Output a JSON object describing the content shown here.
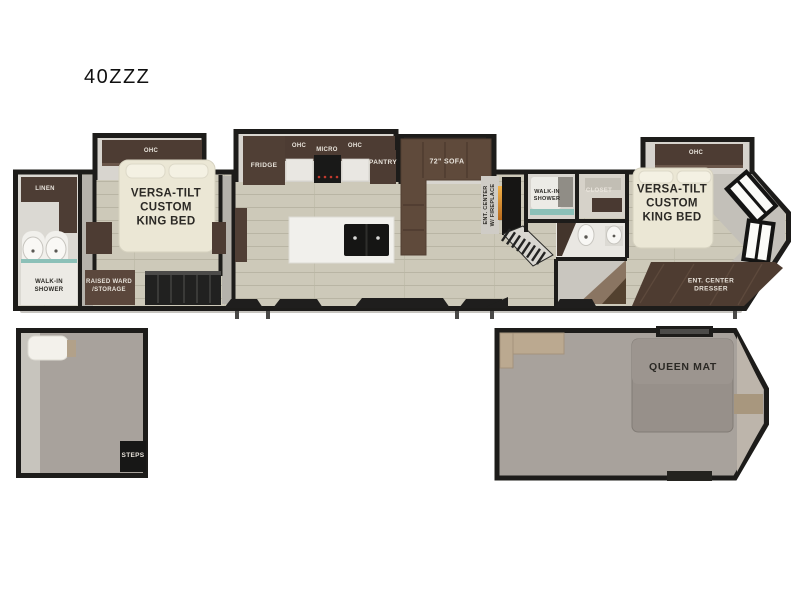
{
  "title": "40ZZZ",
  "colors": {
    "wall": "#1d1c1a",
    "wood_floor": "#cdc9b9",
    "cabinet_dark": "#4d3c33",
    "sofa_brown": "#5f4a3b",
    "bed_cream": "#ebe7d5",
    "loft_floor": "#a8a29c",
    "mattress_grey": "#97908a",
    "fireplace_glow": "#e09a35",
    "shower_glass_teal": "#8cc0b8"
  },
  "main_floorplan": {
    "front_bath": {
      "linen": "LINEN",
      "walk_in_shower": "WALK-IN\nSHOWER"
    },
    "front_bedroom": {
      "ohc": "OHC",
      "bed": "VERSA-TILT\nCUSTOM\nKING BED",
      "raised_ward": "RAISED WARD\n/STORAGE"
    },
    "kitchen": {
      "fridge": "FRIDGE",
      "ohc_left": "OHC",
      "micro": "MICRO",
      "ohc_right": "OHC",
      "pantry": "PANTRY",
      "sofa": "72\" SOFA",
      "ent_center": "ENT. CENTER\nW/ FIREPLACE"
    },
    "mid_bath": {
      "walk_in_shower": "WALK-IN\nSHOWER",
      "closet": "CLOSET"
    },
    "rear_bedroom": {
      "ohc": "OHC",
      "bed": "VERSA-TILT\nCUSTOM\nKING BED",
      "dresser": "ENT. CENTER\nDRESSER"
    }
  },
  "front_loft": {
    "steps": "STEPS"
  },
  "rear_loft": {
    "queen_mat": "QUEEN MAT"
  }
}
